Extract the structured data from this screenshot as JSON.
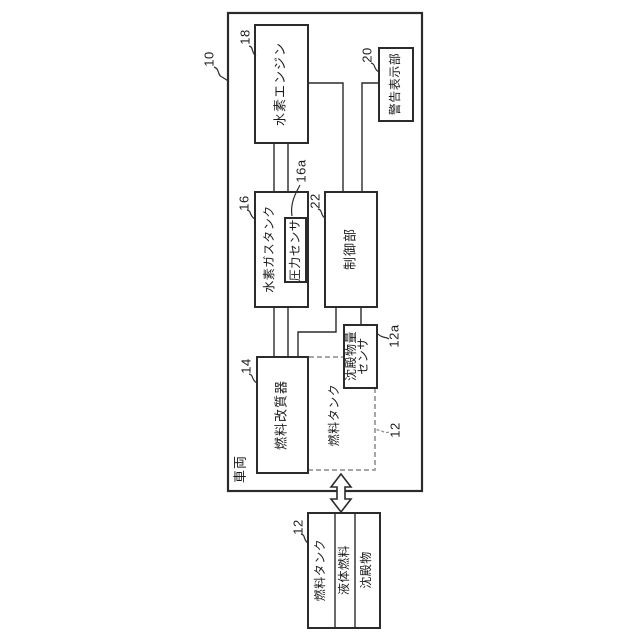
{
  "colors": {
    "line": "#2b2b2b",
    "dashed_line": "#8a8a8a",
    "background": "#ffffff",
    "text": "#1c1c1c"
  },
  "diagram": {
    "vehicle": {
      "ref": "10",
      "label": "車両"
    },
    "engine": {
      "ref": "18",
      "label": "水素エンジン"
    },
    "warning_display": {
      "ref": "20",
      "label": "警告表示部"
    },
    "hydrogen_gas_tank": {
      "ref": "16",
      "label": "水素ガスタンク"
    },
    "pressure_sensor": {
      "ref": "16a",
      "label": "圧力センサ"
    },
    "controller": {
      "ref": "22",
      "label": "制御部"
    },
    "fuel_reformer": {
      "ref": "14",
      "label": "燃料改質器"
    },
    "sediment_sensor": {
      "ref": "12a",
      "label_line1": "沈殿物量",
      "label_line2": "センサ"
    },
    "fuel_tank_outline": {
      "ref": "12",
      "label": "燃料タンク"
    },
    "fuel_tank_detail": {
      "ref": "12",
      "title": "燃料タンク",
      "content_liquid": "液体燃料",
      "content_sediment": "沈殿物"
    }
  }
}
